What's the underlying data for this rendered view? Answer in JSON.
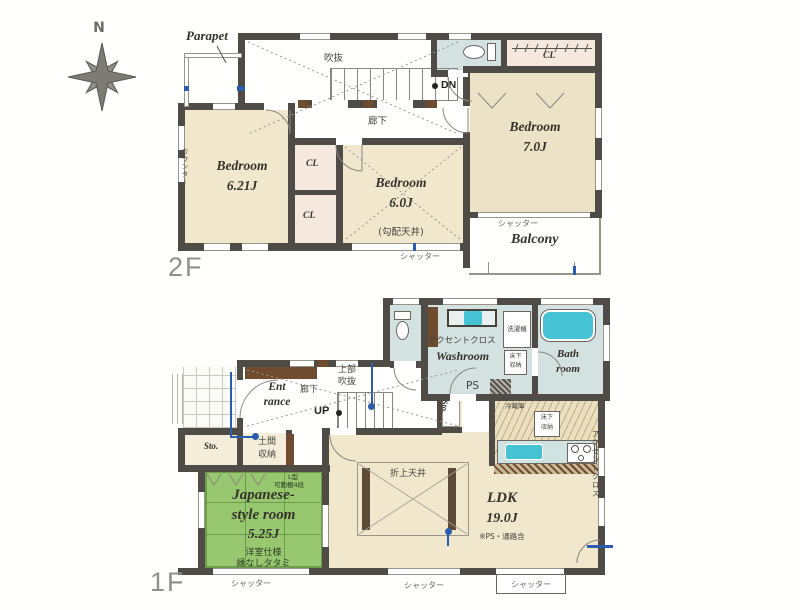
{
  "compass": {
    "north_label": "N"
  },
  "floor2": {
    "floor_label": "2F",
    "parapet_label": "Parapet",
    "void_label": "吹抜",
    "stairs_down_label": "DN",
    "hallway_label": "廊下",
    "counter_label": "カウンター",
    "closet_top_label": "CL",
    "closet_mid_label": "CL",
    "closet_low_label": "CL",
    "bedroom_ne": {
      "name": "Bedroom",
      "size": "7.0J"
    },
    "bedroom_w": {
      "name": "Bedroom",
      "size": "6.21J"
    },
    "bedroom_s": {
      "name": "Bedroom",
      "size": "6.0J",
      "ceiling_note": "(勾配天井)"
    },
    "balcony_label": "Balcony",
    "balcony_shutter_label": "シャッター",
    "south_shutter_label": "シャッター"
  },
  "floor1": {
    "floor_label": "1F",
    "accent_cloth_label": "アクセントクロス",
    "washroom_label": "Washroom",
    "washing_machine_label": "洗濯機",
    "underfloor_storage_washroom": {
      "line1": "床下",
      "line2": "収納"
    },
    "bathroom": {
      "line1": "Bath",
      "line2": "room"
    },
    "pipe_space_label": "PS",
    "refrigerator_label": "冷蔵庫",
    "underfloor_storage_kitchen": {
      "line1": "床下",
      "line2": "収納"
    },
    "entrance": {
      "line1": "Ent",
      "line2": "rance"
    },
    "hallway_label": "廊下",
    "upper_void": {
      "line1": "上部",
      "line2": "吹抜"
    },
    "stairs_up_label": "UP",
    "storage_entrance_label": "Sto.",
    "storage_stairs_label": "Sto.",
    "doma_storage": {
      "line1": "土間",
      "line2": "収納"
    },
    "japanese_room": {
      "shelf_note_line1": "L型",
      "shelf_note_line2": "可動棚4段",
      "name_line1": "Japanese-",
      "name_line2": "style room",
      "size": "5.25J",
      "spec_note": "洋室仕様",
      "tatami_note": "縁なしタタミ"
    },
    "coffered_ceiling_label": "折上天井",
    "ldk": {
      "name": "LDK",
      "size": "19.0J",
      "area_note": "※PS・通路含"
    },
    "accent_cloth_side_label": "アクセントクロス",
    "shutter_left_label": "シャッター",
    "shutter_mid_label": "シャッター",
    "shutter_right_label": "シャッター"
  }
}
